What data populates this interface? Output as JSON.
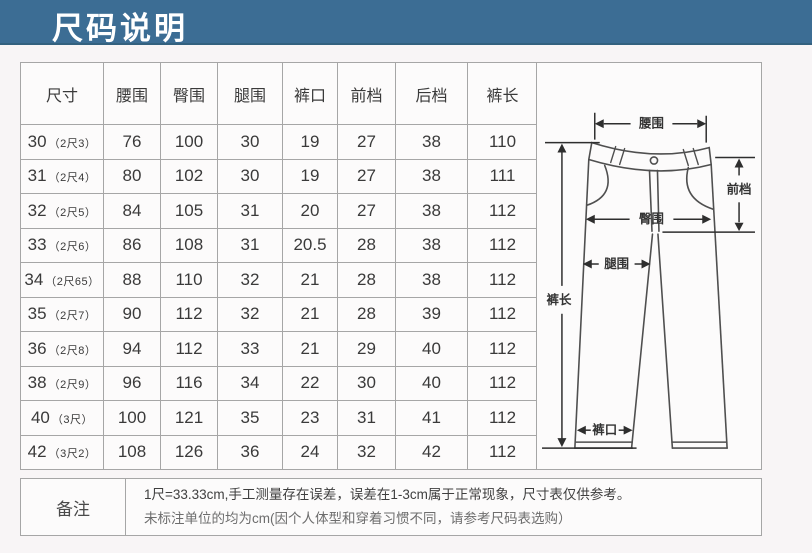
{
  "page": {
    "title": "尺码说明"
  },
  "chart_data": {
    "type": "table",
    "title": "尺码说明",
    "unit_note": "cm",
    "columns": [
      "尺寸",
      "腰围",
      "臀围",
      "腿围",
      "裤口",
      "前档",
      "后档",
      "裤长"
    ],
    "rows": [
      {
        "size": "30",
        "size_note": "（2尺3）",
        "values": [
          "76",
          "100",
          "30",
          "19",
          "27",
          "38",
          "110"
        ]
      },
      {
        "size": "31",
        "size_note": "（2尺4）",
        "values": [
          "80",
          "102",
          "30",
          "19",
          "27",
          "38",
          "111"
        ]
      },
      {
        "size": "32",
        "size_note": "（2尺5）",
        "values": [
          "84",
          "105",
          "31",
          "20",
          "27",
          "38",
          "112"
        ]
      },
      {
        "size": "33",
        "size_note": "（2尺6）",
        "values": [
          "86",
          "108",
          "31",
          "20.5",
          "28",
          "38",
          "112"
        ]
      },
      {
        "size": "34",
        "size_note": "（2尺65）",
        "values": [
          "88",
          "110",
          "32",
          "21",
          "28",
          "38",
          "112"
        ]
      },
      {
        "size": "35",
        "size_note": "（2尺7）",
        "values": [
          "90",
          "112",
          "32",
          "21",
          "28",
          "39",
          "112"
        ]
      },
      {
        "size": "36",
        "size_note": "（2尺8）",
        "values": [
          "94",
          "112",
          "33",
          "21",
          "29",
          "40",
          "112"
        ]
      },
      {
        "size": "38",
        "size_note": "（2尺9）",
        "values": [
          "96",
          "116",
          "34",
          "22",
          "30",
          "40",
          "112"
        ]
      },
      {
        "size": "40",
        "size_note": "（3尺）",
        "values": [
          "100",
          "121",
          "35",
          "23",
          "31",
          "41",
          "112"
        ]
      },
      {
        "size": "42",
        "size_note": "（3尺2）",
        "values": [
          "108",
          "126",
          "36",
          "24",
          "32",
          "42",
          "112"
        ]
      }
    ]
  },
  "remarks": {
    "label": "备注",
    "line1": "1尺=33.33cm,手工测量存在误差，误差在1-3cm属于正常现象，尺寸表仅供参考。",
    "line2": "未标注单位的均为cm(因个人体型和穿着习惯不同，请参考尺码表选购）"
  },
  "diagram": {
    "labels": {
      "waist": "腰围",
      "front_rise": "前档",
      "hip": "臀围",
      "thigh": "腿围",
      "length": "裤长",
      "hem": "裤口"
    }
  },
  "colors": {
    "header_band": "#3c6d94",
    "title_text": "#ffffff",
    "border": "#a6a6a6",
    "cell_bg": "#fcfbfb",
    "page_bg": "#f8f5f6",
    "text": "#3a3a3a"
  }
}
